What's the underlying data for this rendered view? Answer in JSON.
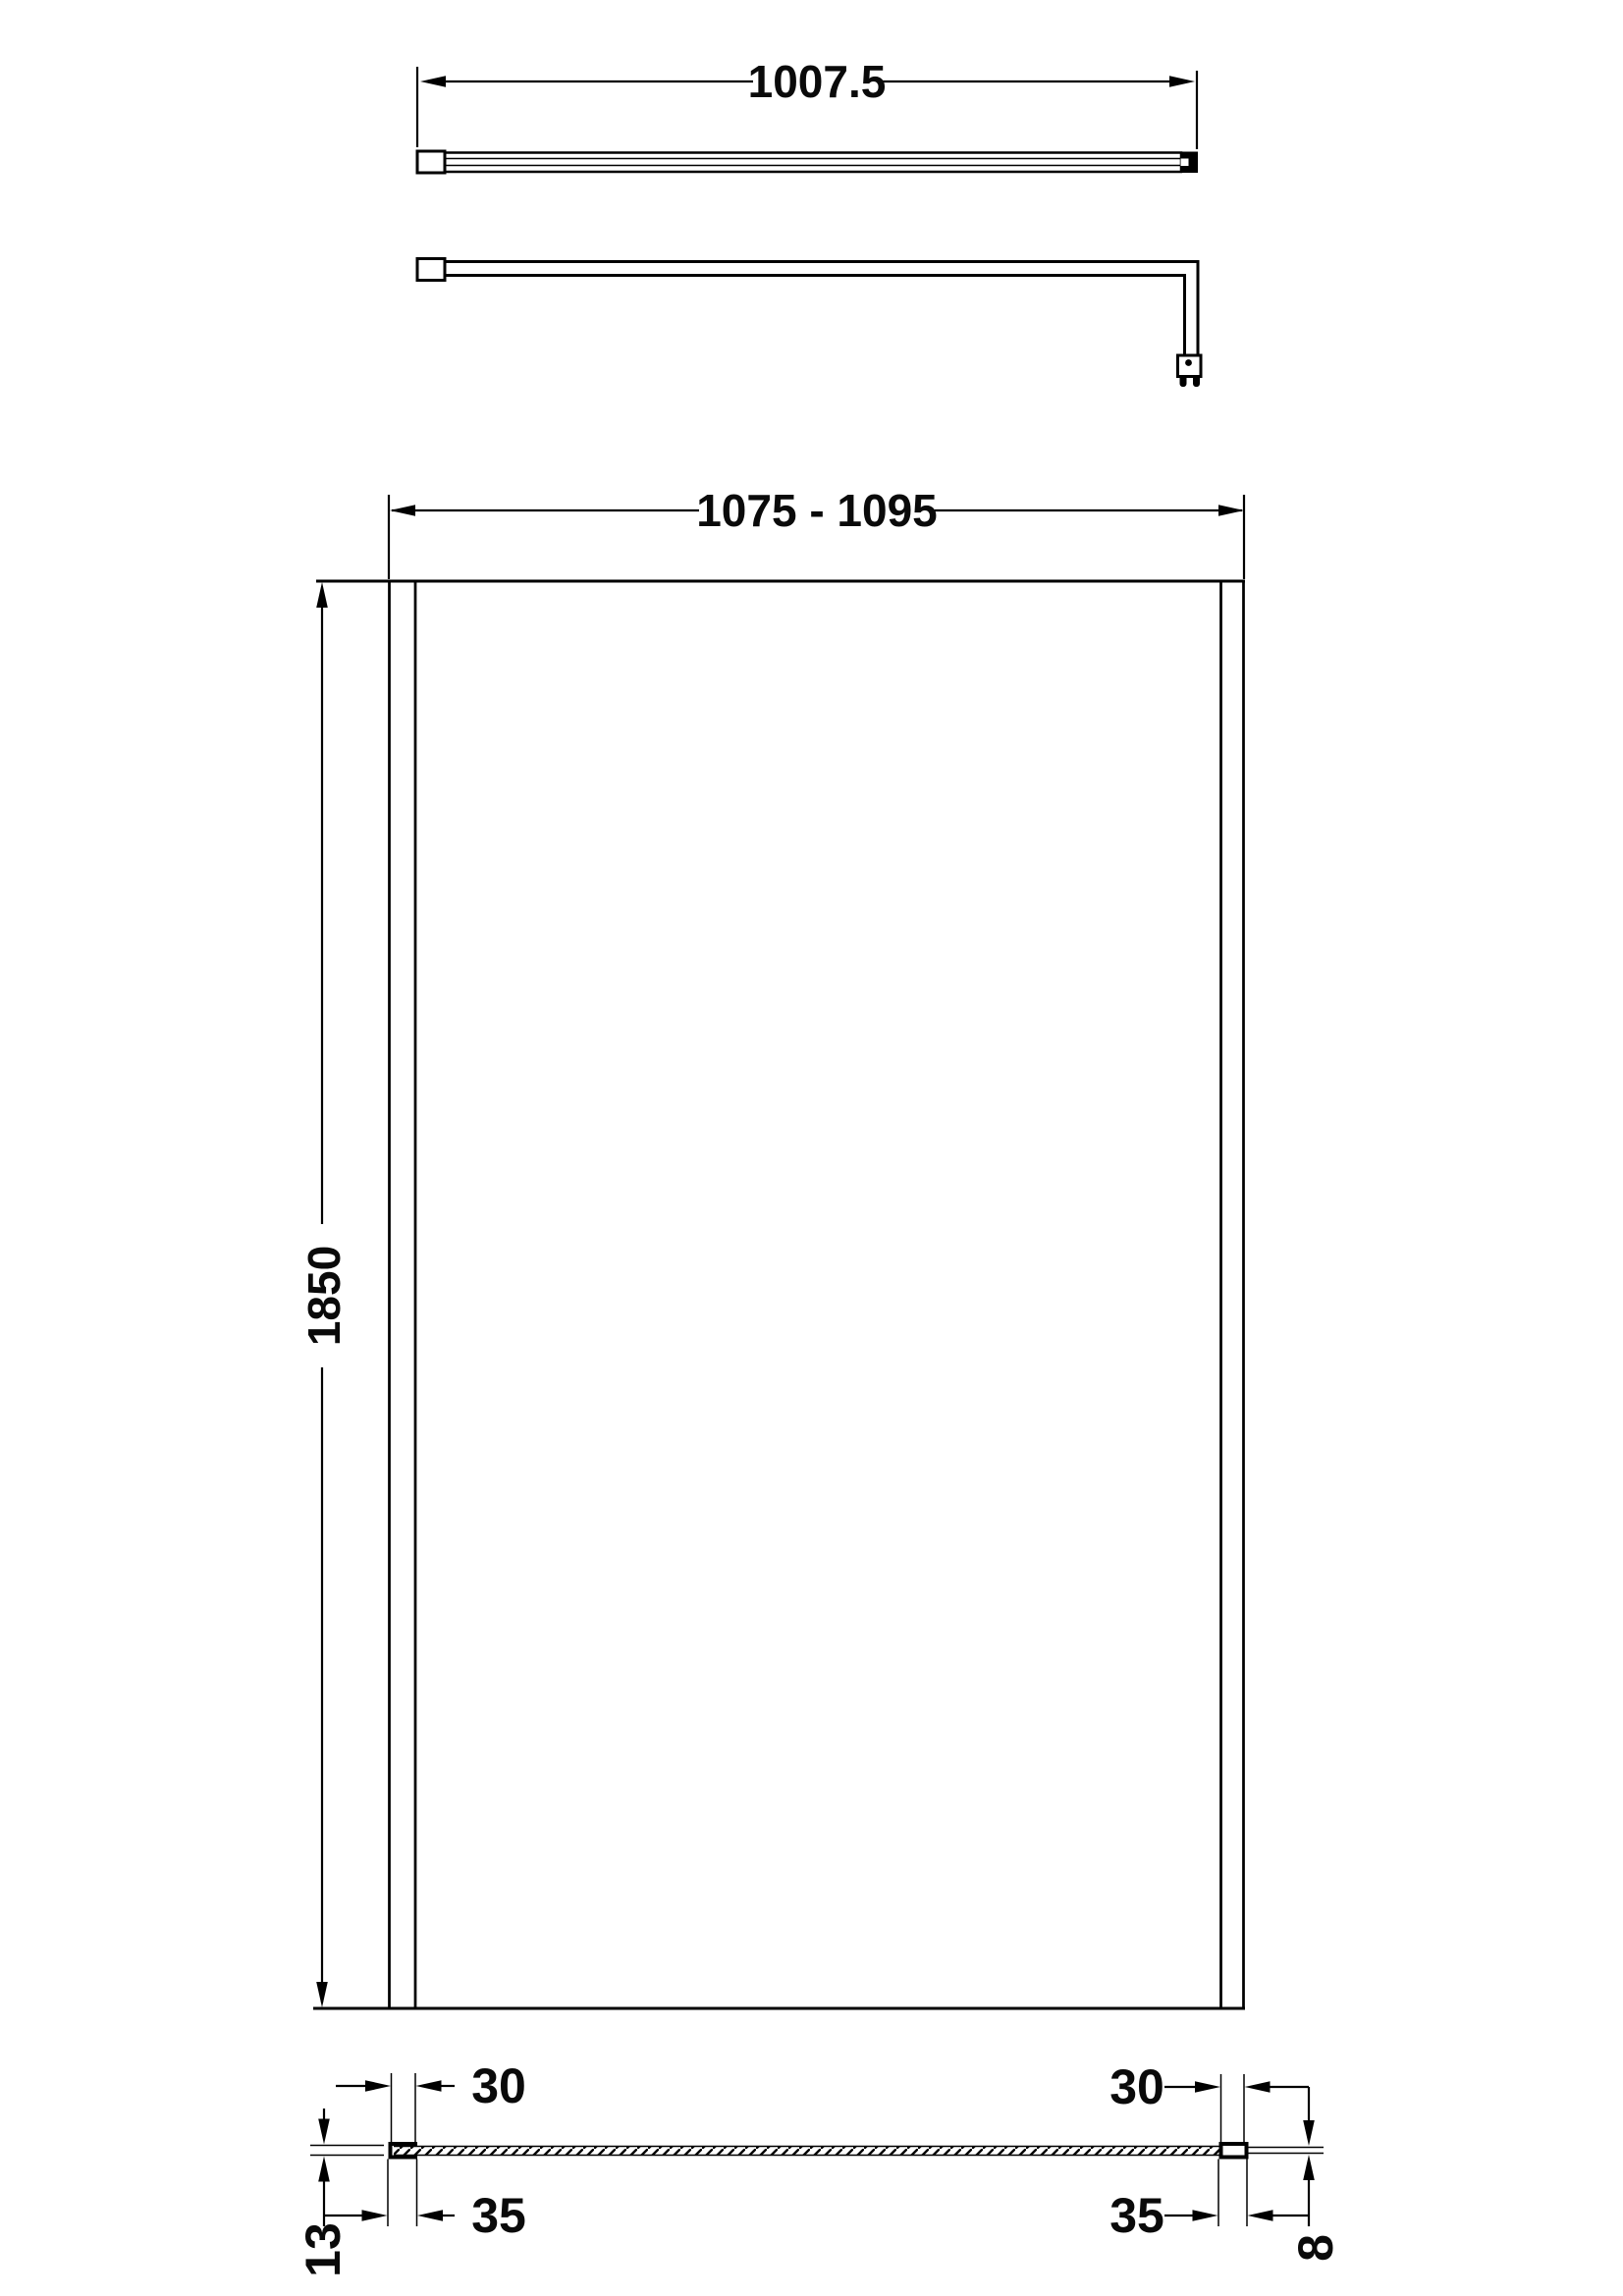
{
  "drawing": {
    "background_color": "#ffffff",
    "line_color": "#000000",
    "dimensions": {
      "bar_length": "1007.5",
      "panel_width_range": "1075 - 1095",
      "panel_height": "1850",
      "left_profile_width": "30",
      "right_profile_width": "30",
      "left_profile_outer_width": "35",
      "right_profile_outer_width": "35",
      "wall_channel_depth": "13",
      "glass_thickness": "8"
    }
  }
}
